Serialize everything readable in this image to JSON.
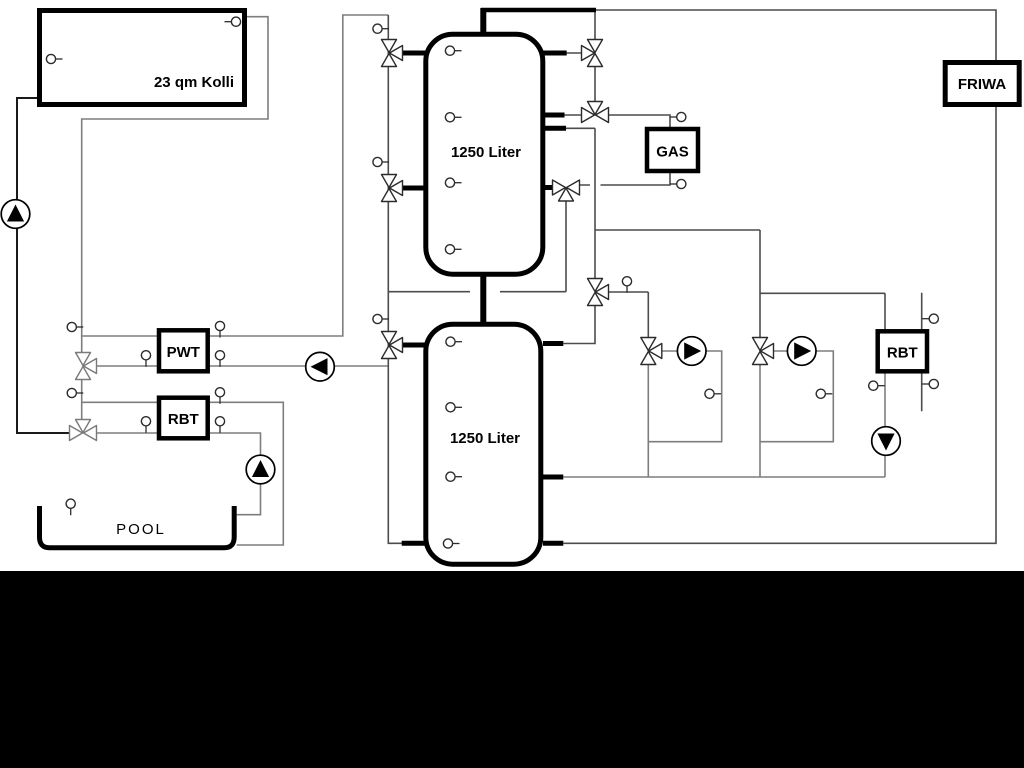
{
  "labels": {
    "collector": "23 qm Kolli",
    "tank_upper": "1250 Liter",
    "tank_lower": "1250 Liter",
    "gas": "GAS",
    "friwa": "FRIWA",
    "pwt": "PWT",
    "rbt_left": "RBT",
    "rbt_right": "RBT",
    "pool": "POOL"
  },
  "colors": {
    "background": "#ffffff",
    "bottom_bar": "#000000",
    "line_dark": "#1a1a1a",
    "line_mid": "#4c4c4c",
    "line_gray": "#7e7e7e",
    "component_border": "#000000",
    "pump_fill": "#000000"
  },
  "icons": {
    "pump": "pump-icon",
    "three_way_valve": "three-way-valve-icon",
    "sensor": "temperature-sensor-icon"
  }
}
